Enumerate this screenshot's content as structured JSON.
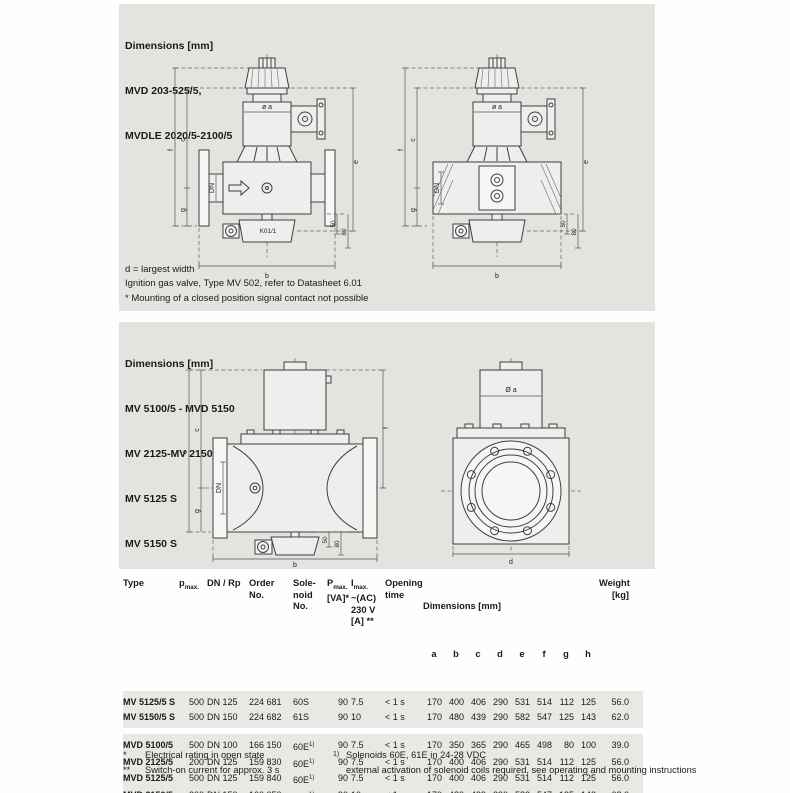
{
  "colors": {
    "panel_bg": "#e4e3e0",
    "table_band_bg": "#e9e8e5",
    "text": "#1a1a1a"
  },
  "section_top": {
    "title": "Dimensions [mm]",
    "models": [
      "MVD 203-525/5,",
      "MVDLE 2020/5-2100/5"
    ],
    "notes": [
      "d = largest width",
      "Ignition gas valve, Type MV 502, refer to Datasheet 6.01",
      "* Mounting of a closed position signal contact not possible"
    ]
  },
  "section_mid": {
    "title": "Dimensions [mm]",
    "models": [
      "MV 5100/5 - MVD 5150",
      "MV 2125-MV 2150",
      "MV 5125 S",
      "MV 5150 S"
    ]
  },
  "drawing_labels": {
    "f": "f",
    "c": "c",
    "e": "e",
    "g": "g",
    "a": "a",
    "dn": "DN",
    "dia_a": "ø a",
    "dia_a_cap": "Ø a",
    "fifty": "50",
    "eighty": "80",
    "b": "b",
    "d": "d",
    "k01": "K01/1"
  },
  "table": {
    "headers": {
      "type": "Type",
      "pmax_base": "p",
      "pmax_sub": "max.",
      "dn_rp": "DN / Rp",
      "order_l1": "Order",
      "order_l2": "No.",
      "sol_l1": "Sole-",
      "sol_l2": "noid",
      "sol_l3": "No.",
      "pva_base": "P",
      "pva_sub": "max.",
      "pva_l2": "[VA]*",
      "imax_base": "I",
      "imax_sub": "max.",
      "imax_l2": "~(AC)",
      "imax_l3": "230 V",
      "imax_l4": "[A] **",
      "open_l1": "Opening",
      "open_l2": "time",
      "dims_title": "Dimensions [mm]",
      "dim_letters": [
        "a",
        "b",
        "c",
        "d",
        "e",
        "f",
        "g",
        "h"
      ],
      "weight_l1": "Weight",
      "weight_l2": "[kg]"
    },
    "groups": [
      {
        "rows": [
          {
            "type": "MV 5125/5 S",
            "pmax": "500",
            "dn": "DN 125",
            "order": "224 681",
            "solenoid": "60S",
            "sol_sup": "",
            "pva": "90",
            "imax": "7.5",
            "opening": "< 1 s",
            "dims": [
              "170",
              "400",
              "406",
              "290",
              "531",
              "514",
              "112",
              "125"
            ],
            "weight": "56.0"
          },
          {
            "type": "MV 5150/5 S",
            "pmax": "500",
            "dn": "DN 150",
            "order": "224 682",
            "solenoid": "61S",
            "sol_sup": "",
            "pva": "90",
            "imax": "10",
            "opening": "< 1 s",
            "dims": [
              "170",
              "480",
              "439",
              "290",
              "582",
              "547",
              "125",
              "143"
            ],
            "weight": "62.0"
          }
        ]
      },
      {
        "rows": [
          {
            "type": "MVD 5100/5",
            "pmax": "500",
            "dn": "DN 100",
            "order": "166 150",
            "solenoid": "60E",
            "sol_sup": "1)",
            "pva": "90",
            "imax": "7.5",
            "opening": "< 1 s",
            "dims": [
              "170",
              "350",
              "365",
              "290",
              "465",
              "498",
              "80",
              "100"
            ],
            "weight": "39.0"
          },
          {
            "type": "MVD 2125/5",
            "pmax": "200",
            "dn": "DN 125",
            "order": "159 830",
            "solenoid": "60E",
            "sol_sup": "1)",
            "pva": "90",
            "imax": "7.5",
            "opening": "< 1 s",
            "dims": [
              "170",
              "400",
              "406",
              "290",
              "531",
              "514",
              "112",
              "125"
            ],
            "weight": "56.0"
          },
          {
            "type": "MVD 5125/5",
            "pmax": "500",
            "dn": "DN 125",
            "order": "159 840",
            "solenoid": "60E",
            "sol_sup": "1)",
            "pva": "90",
            "imax": "7.5",
            "opening": "< 1 s",
            "dims": [
              "170",
              "400",
              "406",
              "290",
              "531",
              "514",
              "112",
              "125"
            ],
            "weight": "56.0"
          },
          {
            "type": "MVD 2150/5",
            "pmax": "200",
            "dn": "DN 150",
            "order": "160 050",
            "solenoid": "61E",
            "sol_sup": "1)",
            "pva": "90",
            "imax": "10",
            "opening": "< 1 s",
            "dims": [
              "170",
              "480",
              "439",
              "290",
              "582",
              "547",
              "125",
              "143"
            ],
            "weight": "62.0"
          },
          {
            "type": "MVD 5150/5",
            "pmax": "500",
            "dn": "DN 150",
            "order": "160 350",
            "solenoid": "61E",
            "sol_sup": "1)",
            "pva": "90",
            "imax": "10",
            "opening": "< 1 s",
            "dims": [
              "170",
              "480",
              "439",
              "",
              "582",
              "547",
              "125",
              "143"
            ],
            "weight": "62.0"
          }
        ]
      }
    ]
  },
  "footnotes": {
    "star_marker": "*",
    "star_text": "Electrical rating in open state",
    "dstar_marker": "**",
    "dstar_text": "Switch-on current for approx. 3 s",
    "sup_marker": "1)",
    "sup_text": "Solenoids 60E, 61E in 24-28 VDC",
    "cont_text": "external activation of solenoid coils required, see operating and mounting instructions"
  }
}
